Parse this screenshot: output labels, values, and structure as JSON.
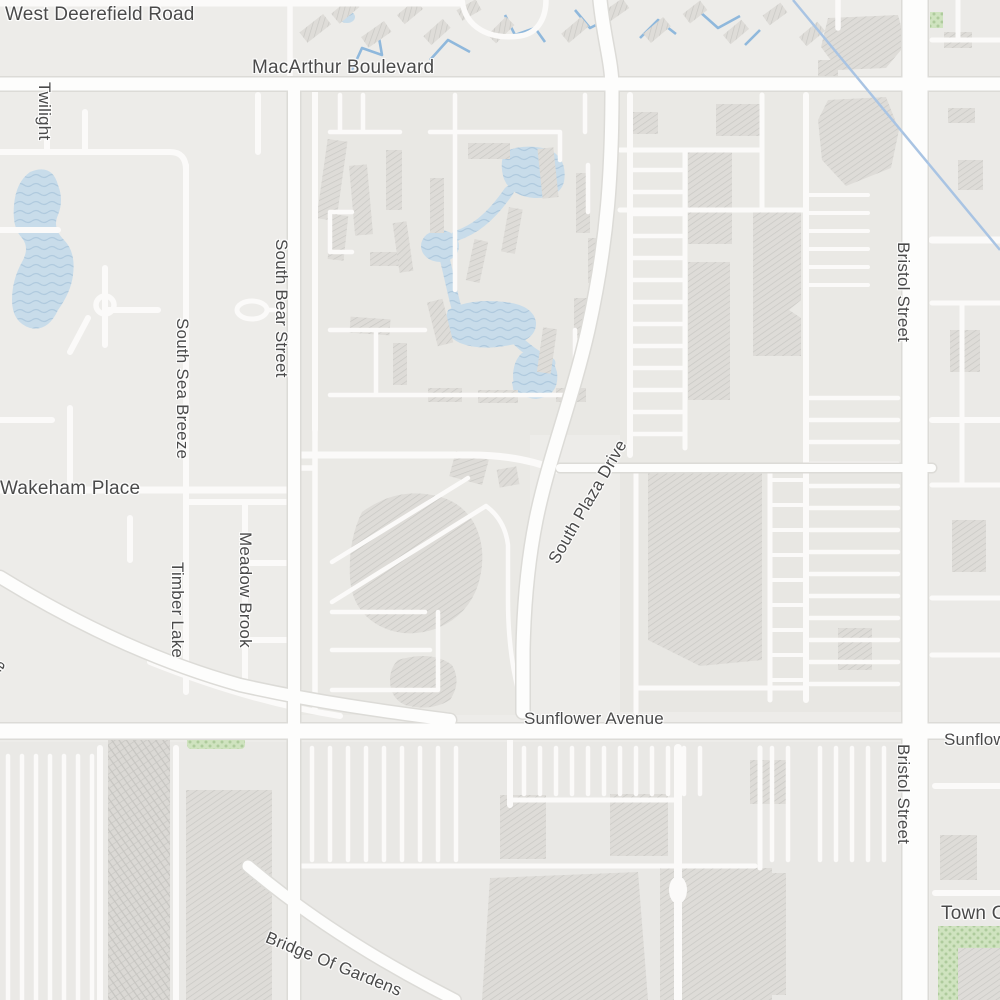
{
  "map": {
    "style": "light-street-map",
    "colors": {
      "background": "#edece9",
      "block": "#e8e7e3",
      "road": "#fdfdfc",
      "road_casing": "#dcdbd7",
      "water": "#c8dcea",
      "water_wave": "#b0cade",
      "canal": "#8fb8dc",
      "building": "#dedcd8",
      "building_hatch": "#c9c8c4",
      "green_area": "#cfe3bf",
      "label_text": "#4a4a4a",
      "overlay_line": "#a9c4e3"
    },
    "labels": {
      "west_deerefield_road": {
        "text": "West Deerefield Road"
      },
      "macarthur_boulevard": {
        "text": "MacArthur Boulevard"
      },
      "twilight": {
        "text": "Twilight"
      },
      "south_bear_street": {
        "text": "South Bear Street"
      },
      "south_sea_breeze": {
        "text": "South Sea Breeze"
      },
      "wakeham_place": {
        "text": "Wakeham Place"
      },
      "timber_lake": {
        "text": "Timber Lake"
      },
      "meadow_brook": {
        "text": "Meadow Brook"
      },
      "south_plaza_drive": {
        "text": "South Plaza Drive"
      },
      "bristol_street_upper": {
        "text": "Bristol Street"
      },
      "bristol_street_lower": {
        "text": "Bristol Street"
      },
      "sunflower_avenue": {
        "text": "Sunflower Avenue"
      },
      "sunflower_avenue_clipped": {
        "text": "Sunflower"
      },
      "drive_partial": {
        "text": "ive"
      },
      "bridge_of_gardens": {
        "text": "Bridge Of Gardens"
      },
      "town_center_clipped": {
        "text": "Town Center"
      }
    }
  }
}
